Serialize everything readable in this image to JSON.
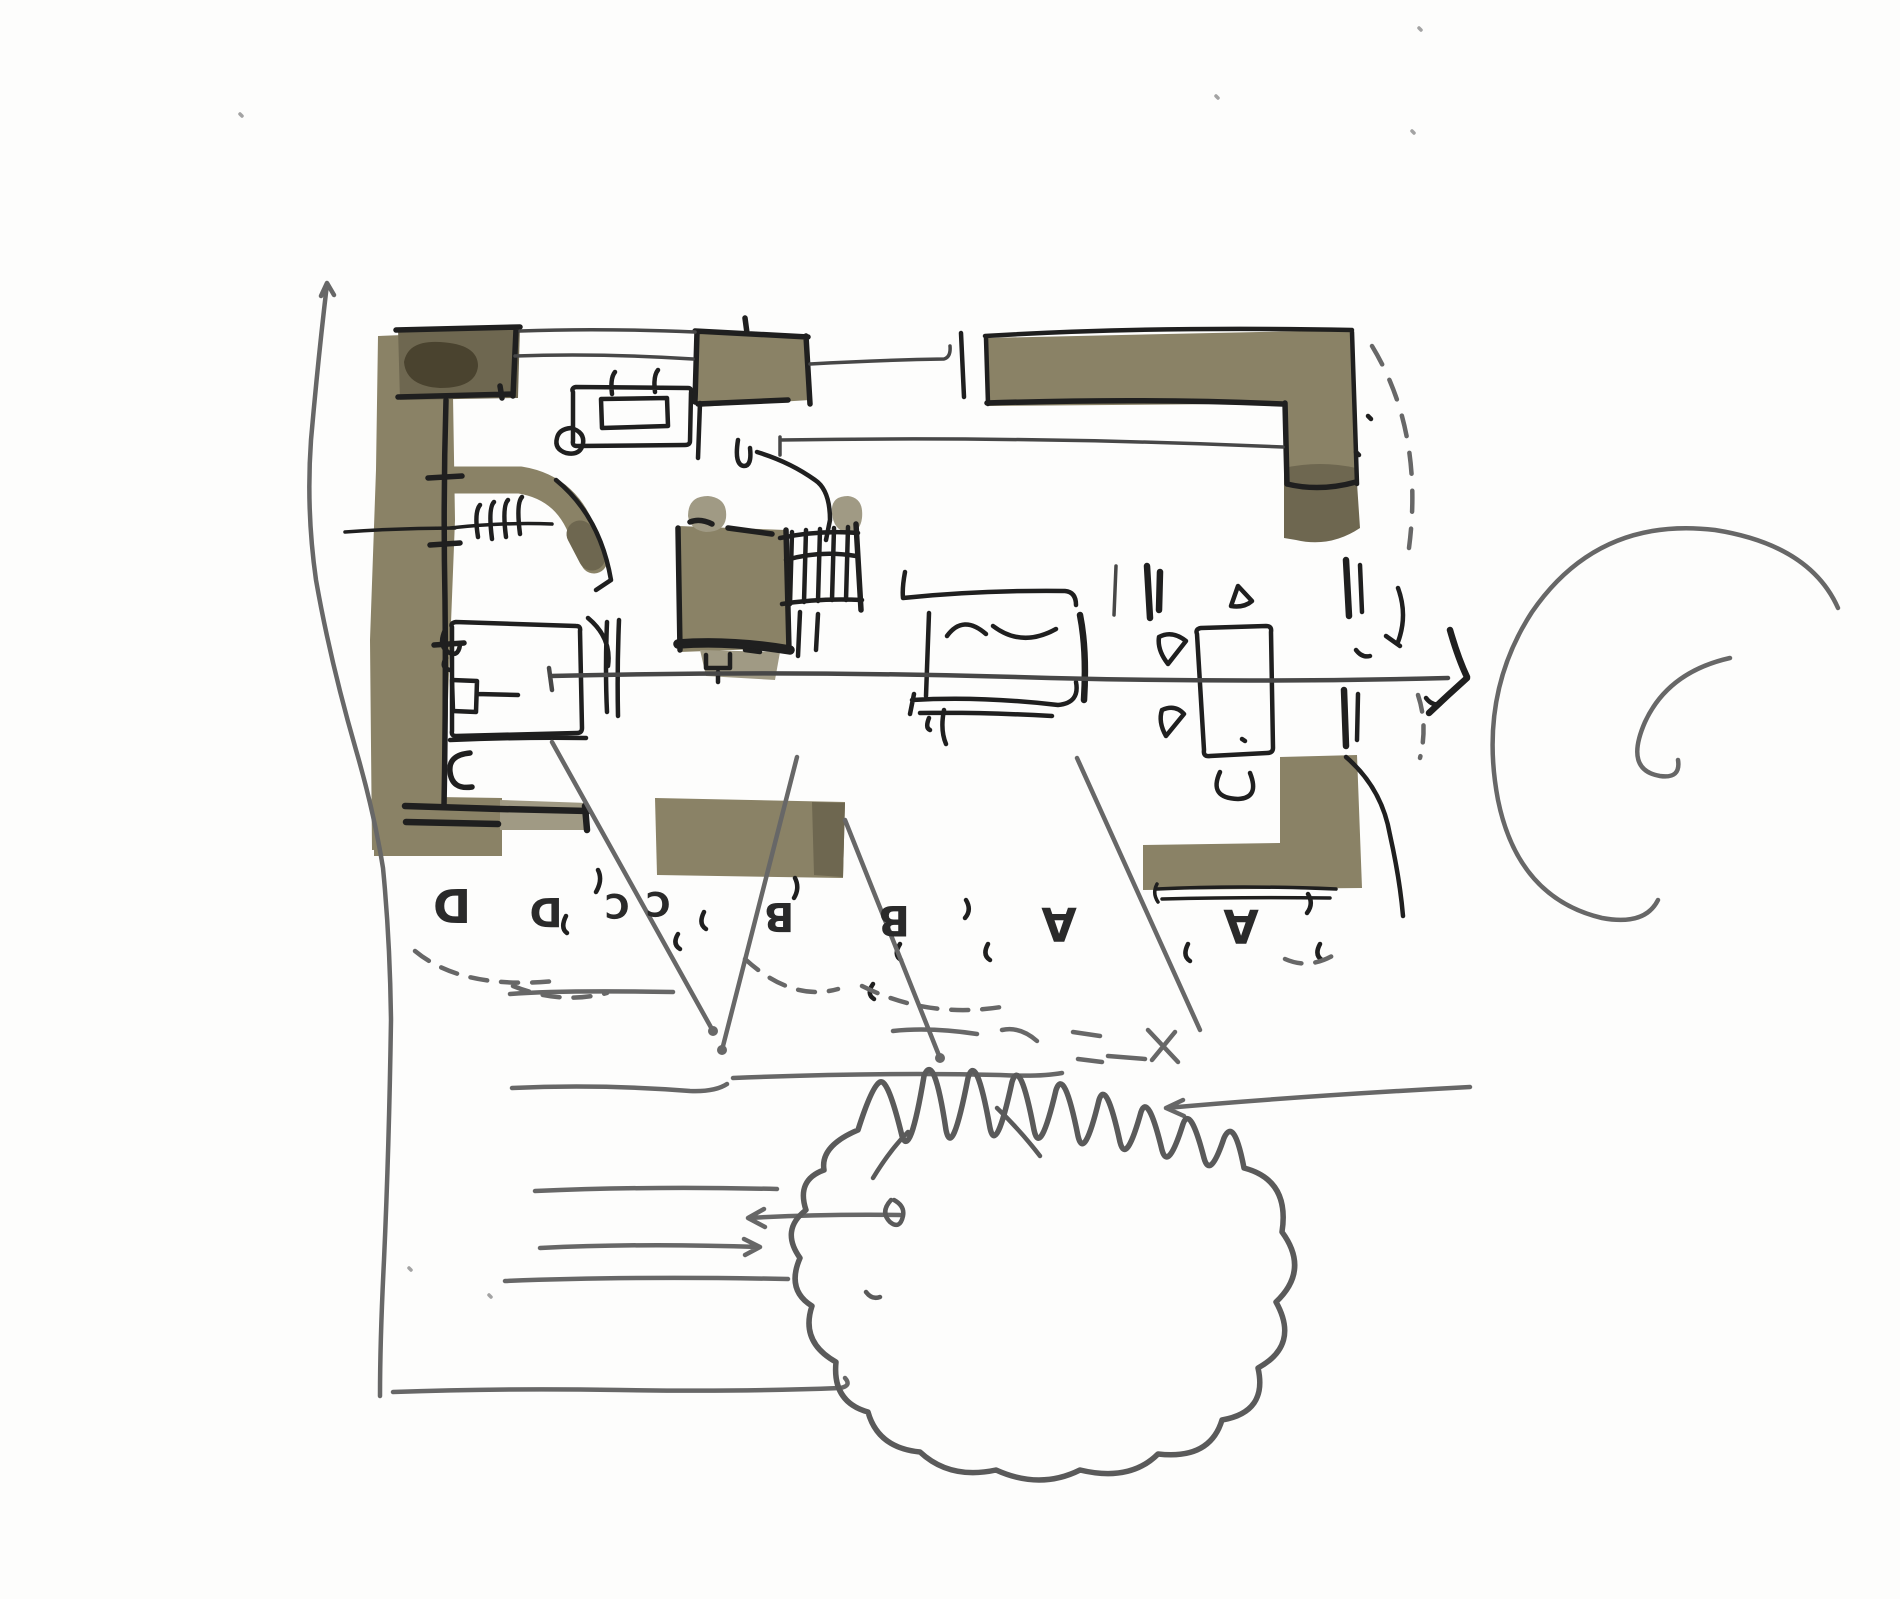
{
  "document": {
    "kind": "hand-drawn architectural floor plan sketch",
    "media": "ink pen and grey-olive marker wash on white paper"
  },
  "colors": {
    "paper": "#fdfdfc",
    "ink": "#1f1f1f",
    "pen_dark": "#2a2a2a",
    "pen_thin": "#474747",
    "pencil": "#676767",
    "tree_line": "#5a5a5a",
    "wash": "#8a8266",
    "wash_dark": "#6e6750",
    "wash_darker": "#4a432f",
    "wash_light": "#a09a84"
  },
  "zones": {
    "sequence": "D D C C B B A A",
    "orientation": "letters written upside-down (rotated 180 degrees)",
    "items": [
      {
        "label": "D"
      },
      {
        "label": "D"
      },
      {
        "label": "C"
      },
      {
        "label": "C"
      },
      {
        "label": "B"
      },
      {
        "label": "B"
      },
      {
        "label": "A"
      },
      {
        "label": "A"
      }
    ]
  }
}
